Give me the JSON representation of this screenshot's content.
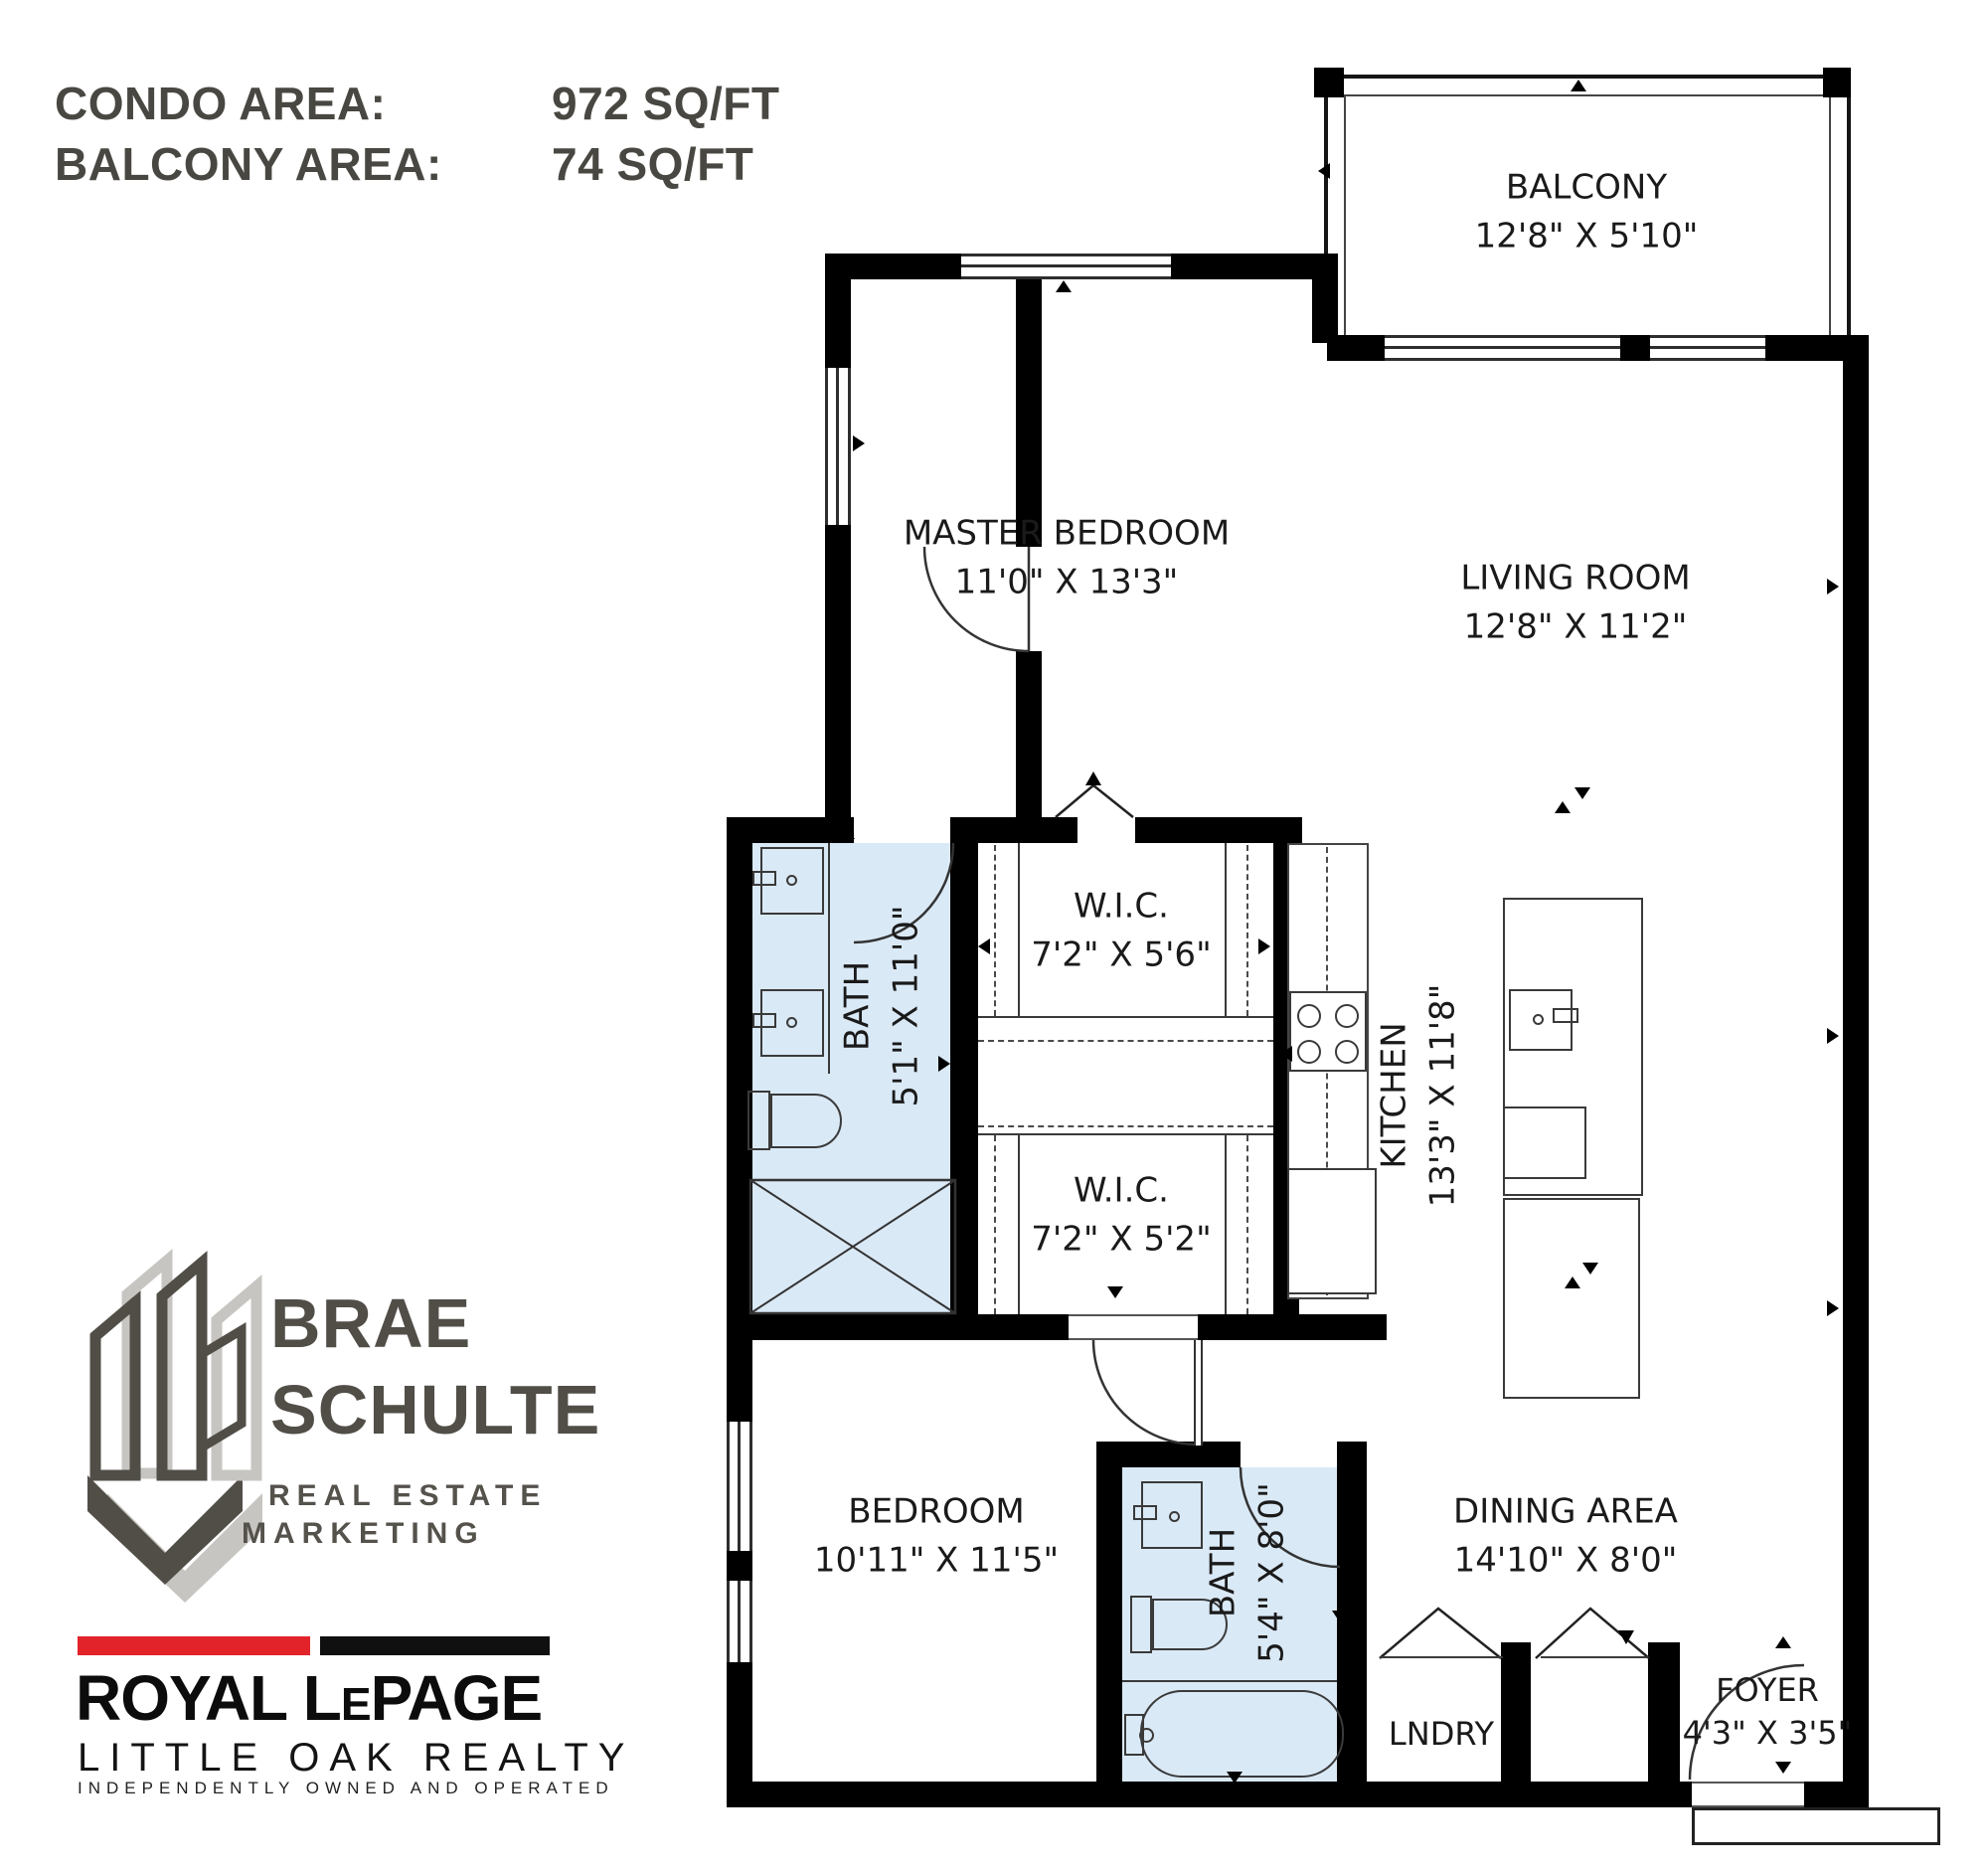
{
  "header": {
    "rows": [
      {
        "label": "CONDO AREA:",
        "value": "972 SQ/FT"
      },
      {
        "label": "BALCONY AREA:",
        "value": "74 SQ/FT"
      }
    ]
  },
  "rooms": {
    "balcony": {
      "name": "BALCONY",
      "dims": "12'8\" X 5'10\""
    },
    "master": {
      "name": "MASTER BEDROOM",
      "dims": "11'0\" X 13'3\""
    },
    "living": {
      "name": "LIVING ROOM",
      "dims": "12'8\" X 11'2\""
    },
    "wic1": {
      "name": "W.I.C.",
      "dims": "7'2\" X 5'6\""
    },
    "wic2": {
      "name": "W.I.C.",
      "dims": "7'2\" X 5'2\""
    },
    "bath1": {
      "name": "BATH",
      "dims": "5'1\" X 11'0\""
    },
    "kitchen": {
      "name": "KITCHEN",
      "dims": "13'3\" X 11'8\""
    },
    "bedroom": {
      "name": "BEDROOM",
      "dims": "10'11\" X 11'5\""
    },
    "bath2": {
      "name": "BATH",
      "dims": "5'4\" X 8'0\""
    },
    "dining": {
      "name": "DINING AREA",
      "dims": "14'10\" X 8'0\""
    },
    "laundry": {
      "name": "LNDRY"
    },
    "foyer": {
      "name": "FOYER",
      "dims": "4'3\" X 3'5\""
    }
  },
  "branding": {
    "agent": {
      "line1": "BRAE",
      "line2": "SCHULTE",
      "tag1": "REAL ESTATE",
      "tag2": "MARKETING"
    },
    "brokerage": {
      "lp1": "ROYAL L",
      "lp2": "E",
      "lp3": "PAGE",
      "sub": "LITTLE OAK REALTY",
      "tagline": "INDEPENDENTLY OWNED AND OPERATED",
      "red": "#e2232a",
      "black": "#101010"
    }
  },
  "colors": {
    "bath_fill": "#dae9f6",
    "wall": "#000000",
    "label": "#1a1a1a"
  }
}
